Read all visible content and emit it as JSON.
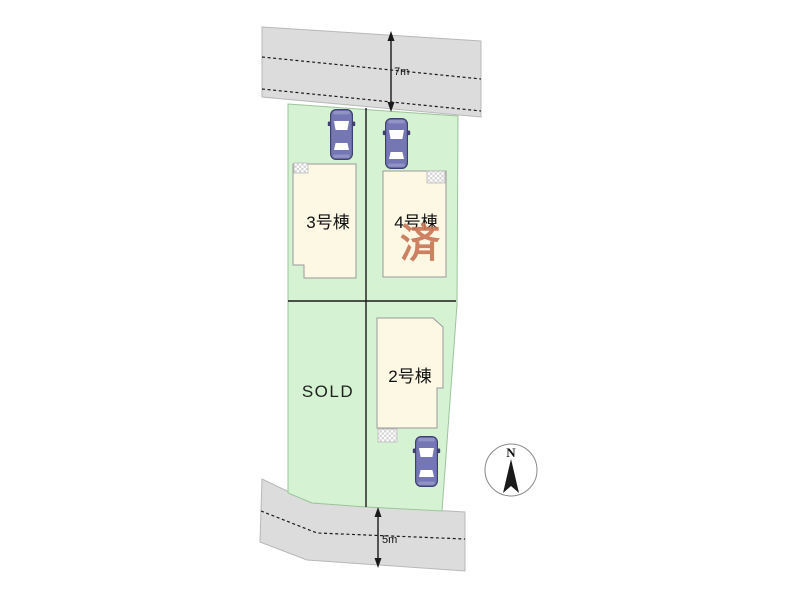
{
  "plan": {
    "roads": {
      "top_width_label": "7m",
      "bottom_width_label": "5m"
    },
    "lots": {
      "lot3_label": "3号棟",
      "lot4_label": "4号棟",
      "lot4_sold_stamp": "済",
      "lot2_label": "2号棟",
      "sold_lot_label": "SOLD"
    },
    "compass": {
      "north_label": "N"
    },
    "colors": {
      "plot_green": "#d5f2d2",
      "road_gray": "#dcdcdc",
      "house_cream": "#fcf8e4",
      "stamp_red": "#c97454",
      "car_body": "#7577b5",
      "car_outline": "#3f3f70"
    }
  }
}
